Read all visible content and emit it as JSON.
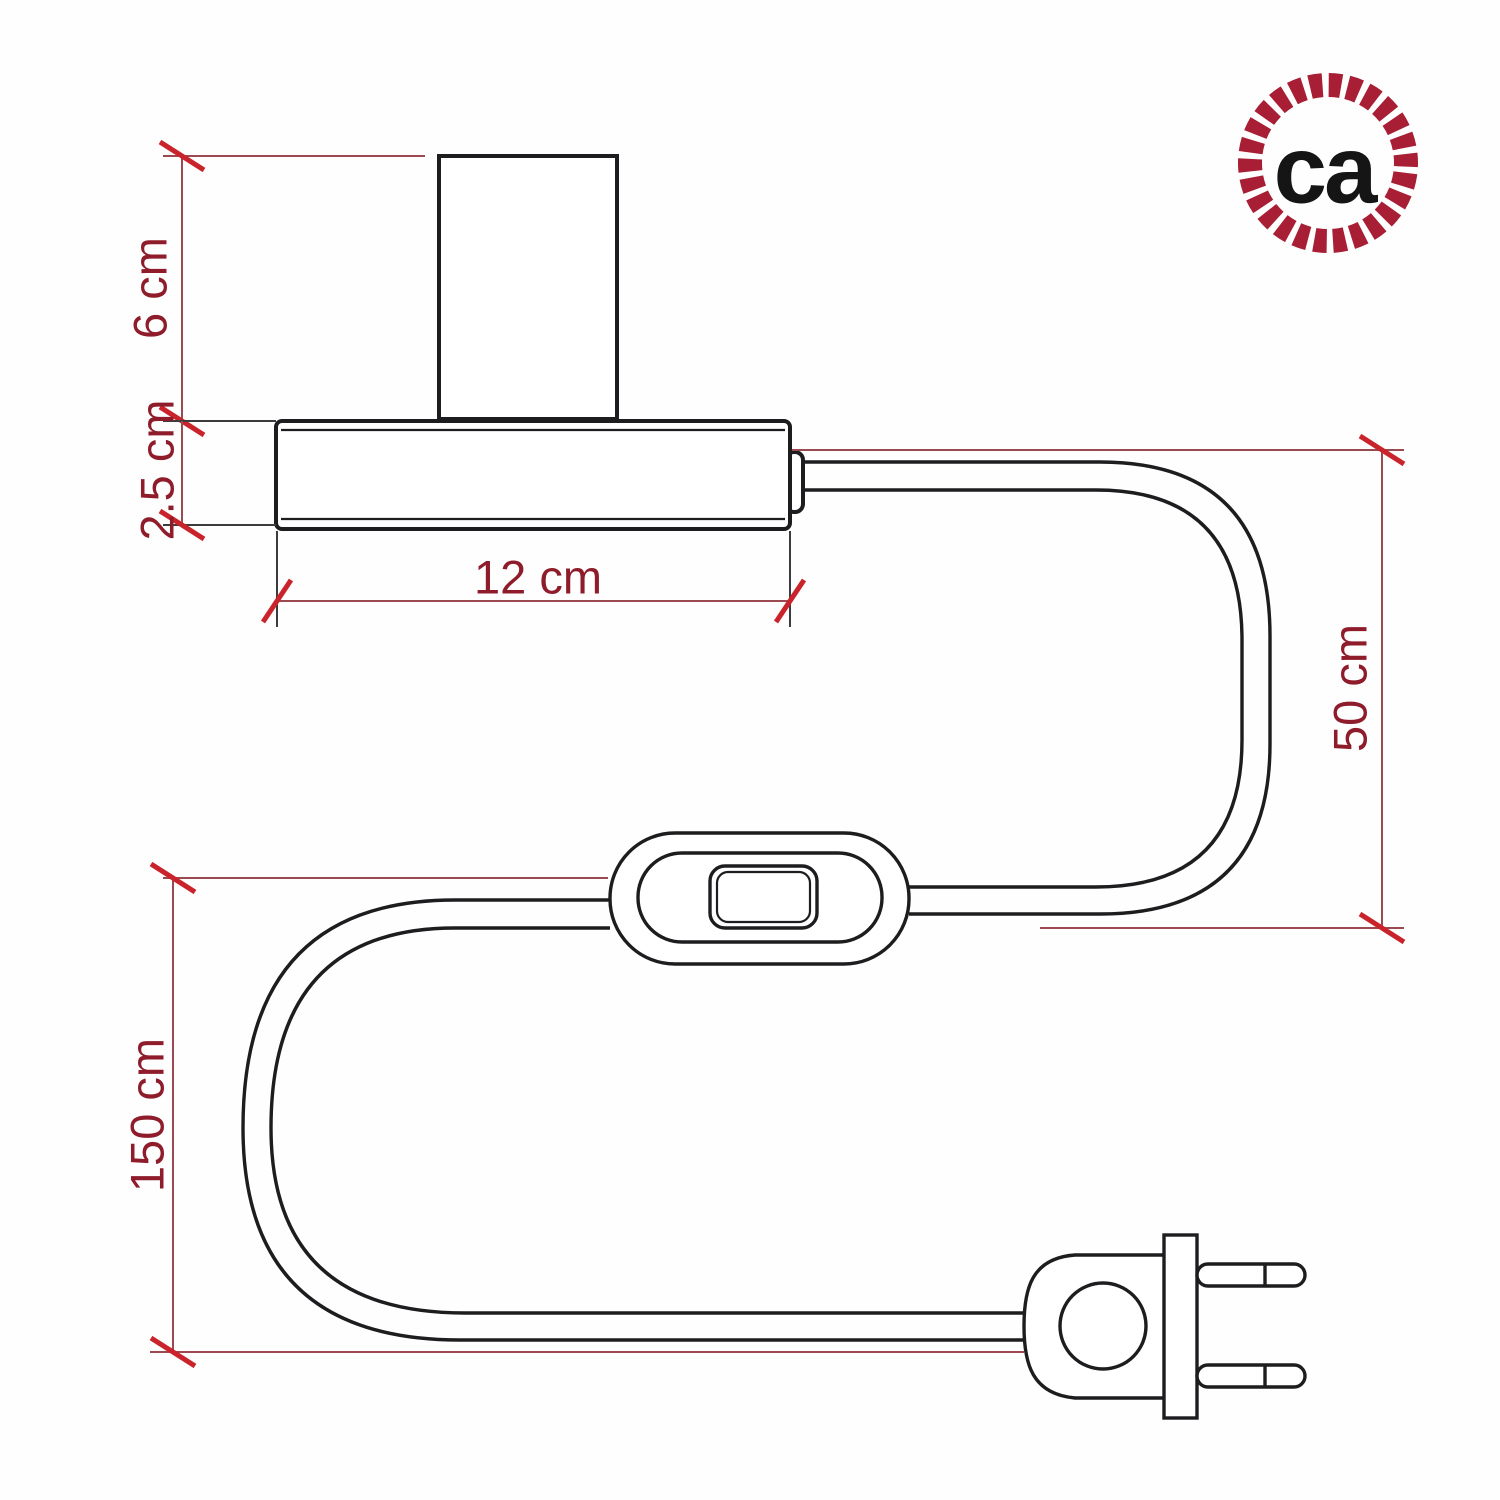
{
  "colors": {
    "background": "#fefefe",
    "ink": "#1d1d1f",
    "dim_line": "#9c4a52",
    "dim_tick": "#c9232b",
    "dim_text": "#8e1c2b",
    "ext_dark": "#3c3c3e",
    "logo_ring": "#a81e35",
    "logo_text": "#151515"
  },
  "labels": {
    "socket_height": "6 cm",
    "base_thickness": "2.5 cm",
    "base_width": "12 cm",
    "cable_upper": "50 cm",
    "cable_total": "150 cm"
  },
  "logo": {
    "text": "ca"
  }
}
